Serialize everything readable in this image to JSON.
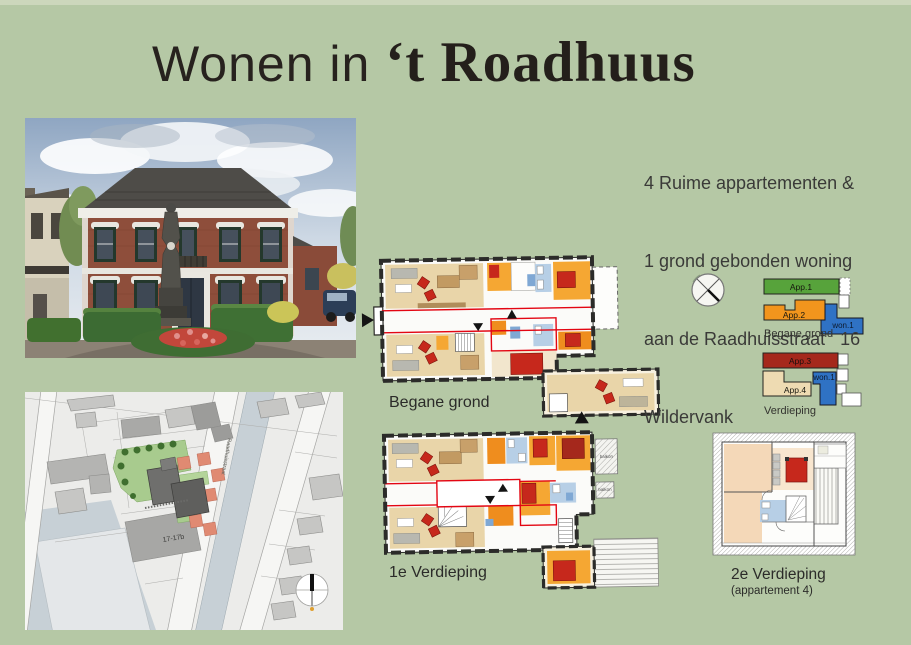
{
  "page": {
    "background_color": "#b5c8a5",
    "title_prefix": "Wonen in",
    "title_name": "‘t Roadhuus",
    "intro_lines": [
      "4 Ruime appartementen &",
      "1 grond gebonden woning",
      "aan de Raadhuisstraat   16",
      "Wildervank"
    ]
  },
  "floor_plans": {
    "ground_label": "Begane grond",
    "first_label": "1e Verdieping",
    "second_label": "2e Verdieping",
    "second_sublabel": "(appartement 4)",
    "balcony_label": "balkon"
  },
  "unit_diagrams": {
    "ground": {
      "caption": "Begane grond",
      "units": [
        {
          "label": "App.1",
          "color": "#57a33b"
        },
        {
          "label": "App.2",
          "color": "#f2951d"
        },
        {
          "label": "won.1",
          "color": "#2f72c4"
        }
      ]
    },
    "upper": {
      "caption": "Verdieping",
      "units": [
        {
          "label": "App.3",
          "color": "#a5281c"
        },
        {
          "label": "App.4",
          "color": "#eedbb2"
        },
        {
          "label": "won.1",
          "color": "#2f72c4"
        }
      ]
    }
  },
  "site_map": {
    "building_label": "17-17b",
    "street_label": "Raadhuisstraat"
  },
  "colors": {
    "plan_red_line": "#e30613",
    "plan_tan": "#e9d5a9",
    "plan_orange": "#f5a733",
    "plan_orange_deep": "#ef8d1e",
    "plan_blue": "#b7cfe6",
    "furniture_red": "#c6281c"
  }
}
